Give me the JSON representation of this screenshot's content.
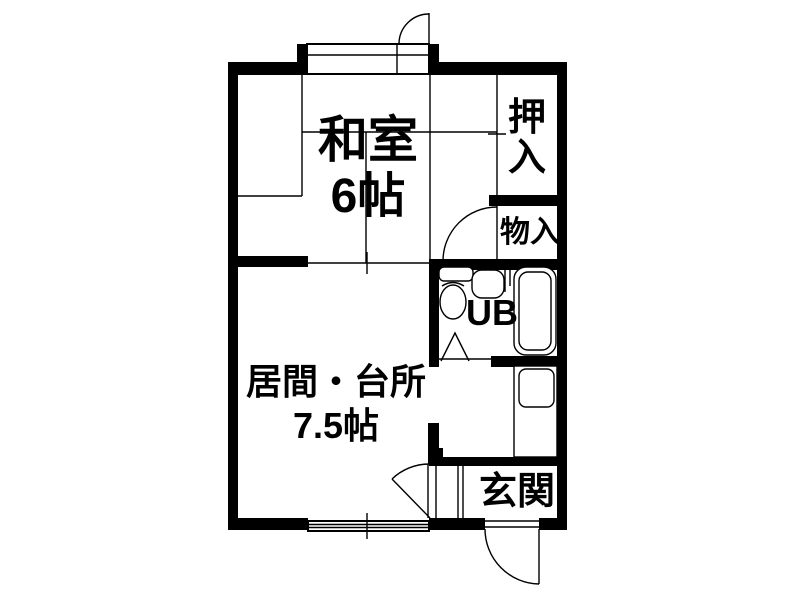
{
  "plan": {
    "type": "floor-plan",
    "rooms": {
      "washitsu": {
        "label": "和室",
        "size": "6帖"
      },
      "living_kitchen": {
        "label": "居間・台所",
        "size": "7.5帖"
      },
      "oshiire": {
        "label": "押入"
      },
      "monoire": {
        "label": "物入"
      },
      "unit_bath": {
        "label": "UB"
      },
      "genkan": {
        "label": "玄関"
      }
    },
    "colors": {
      "line": "#000000",
      "background": "#ffffff"
    }
  }
}
